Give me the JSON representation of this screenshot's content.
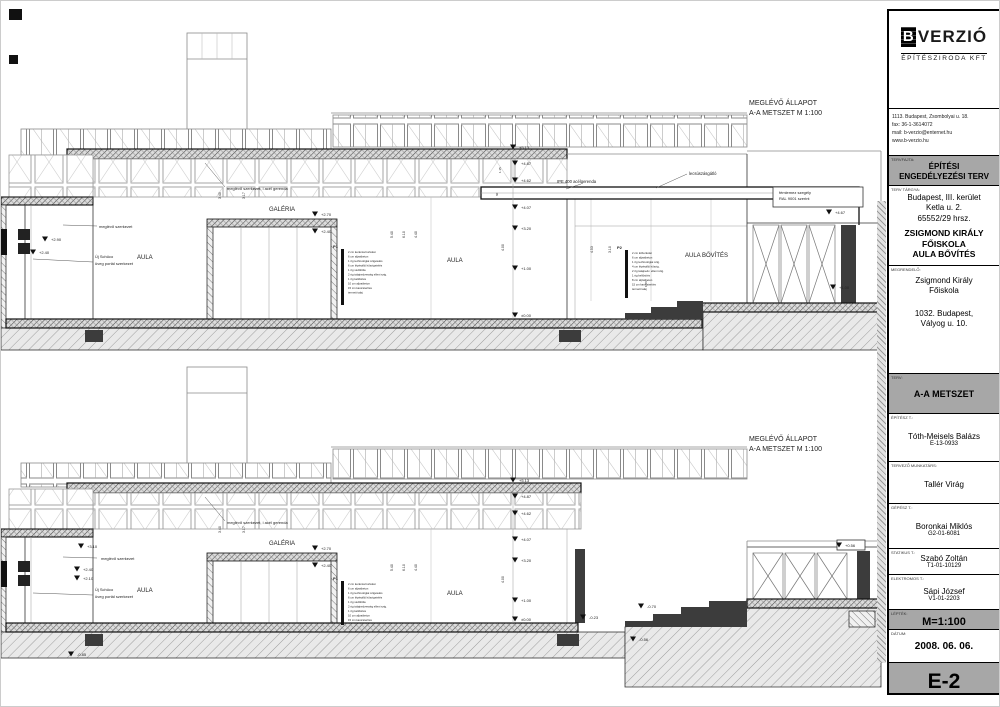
{
  "title_block": {
    "logo": {
      "b": "B",
      "name": "VERZIÓ",
      "sub": "ÉPÍTÉSZIRODA KFT"
    },
    "address_lines": [
      "1113. Budapest, Zsombolyai u. 18.",
      "fax: 36-1-3614072",
      "mail: b-verzio@enternet.hu",
      "www.b-verzio.hu"
    ],
    "tervfajta_label": "TERVFAJTA:",
    "tervfajta_line1": "ÉPÍTÉSI",
    "tervfajta_line2": "ENGEDÉLYEZÉSI TERV",
    "targy_label": "TERV TÁRGYA:",
    "targy_lines": [
      "Budapest, III. kerület",
      "Ketla u. 2.",
      "65552/29 hrsz."
    ],
    "targy_bold": [
      "ZSIGMOND KIRÁLY",
      "FŐISKOLA",
      "AULA BŐVÍTÉS"
    ],
    "megrendelo_label": "MEGRENDELŐ:",
    "megrendelo_lines": [
      "Zsigmond Király",
      "Főiskola"
    ],
    "megrendelo_addr": [
      "1032.  Budapest,",
      "Vályog u. 10."
    ],
    "terv_label": "TERV:",
    "terv": "A-A METSZET",
    "people": [
      {
        "role": "ÉPÍTÉSZ T.:",
        "name": "Tóth-Meisels Balázs",
        "id": "E-13-0933"
      },
      {
        "role": "TERVEZŐ MUNKATÁRS:",
        "name": "Tallér Virág",
        "id": ""
      },
      {
        "role": "GÉPÉSZ T.:",
        "name": "Boronkai Miklós",
        "id": "G2-01-6081"
      },
      {
        "role": "STATIKUS T.:",
        "name": "Szabó Zoltán",
        "id": "T1-01-10129"
      },
      {
        "role": "ELEKTROMOS T.:",
        "name": "Sápi József",
        "id": "V1-01-2203"
      }
    ],
    "leptek_label": "LÉPTÉK:",
    "leptek": "M=1:100",
    "datum_label": "DÁTUM:",
    "datum": "2008. 06. 06.",
    "sheet_no": "E-2"
  },
  "colors": {
    "gray_box": "#a7a7a7",
    "dark_fill": "#3c3c3c",
    "line": "#333333"
  },
  "drawings": {
    "top": {
      "annotations": [
        {
          "t": "MEGLÉVŐ ÁLLAPOT",
          "x": 748,
          "y": 104,
          "s": 7
        },
        {
          "t": "A-A METSZET M 1:100",
          "x": 748,
          "y": 114,
          "s": 7
        },
        {
          "t": "meglévő szerkezet, i acél gerenda",
          "x": 226,
          "y": 189,
          "s": 4
        },
        {
          "t": "GALÉRIA",
          "x": 268,
          "y": 210,
          "s": 6
        },
        {
          "t": "AULA",
          "x": 136,
          "y": 258,
          "s": 6
        },
        {
          "t": "AULA",
          "x": 446,
          "y": 261,
          "s": 6
        },
        {
          "t": "AULA BŐVÍTÉS",
          "x": 684,
          "y": 256,
          "s": 6
        },
        {
          "t": "meglévő szerkezet",
          "x": 98,
          "y": 227,
          "s": 4
        },
        {
          "t": "Új Schüco",
          "x": 94,
          "y": 257,
          "s": 4
        },
        {
          "t": "üveg portál szerkezet",
          "x": 94,
          "y": 264,
          "s": 4
        },
        {
          "t": "IPE 400 acélgerenda",
          "x": 556,
          "y": 182,
          "s": 4.2
        },
        {
          "t": "lecsúszásgátló",
          "x": 688,
          "y": 174,
          "s": 4.2
        },
        {
          "t": "fémlemez szegély",
          "x": 778,
          "y": 193,
          "s": 4
        },
        {
          "t": "RAL 9001 szerint",
          "x": 778,
          "y": 199,
          "s": 4
        },
        {
          "k": "elev",
          "t": "+5.13",
          "x": 518,
          "y": 148,
          "s": 4
        },
        {
          "k": "elev",
          "t": "+4.87",
          "x": 520,
          "y": 164,
          "s": 4
        },
        {
          "k": "elev",
          "t": "+4.62",
          "x": 520,
          "y": 181,
          "s": 4
        },
        {
          "k": "elev",
          "t": "+4.07",
          "x": 520,
          "y": 208,
          "s": 4
        },
        {
          "k": "elev",
          "t": "+3.20",
          "x": 520,
          "y": 229,
          "s": 4
        },
        {
          "k": "elev",
          "t": "+1.00",
          "x": 520,
          "y": 269,
          "s": 4
        },
        {
          "k": "elev",
          "t": "±0.00",
          "x": 520,
          "y": 316,
          "s": 4
        },
        {
          "k": "elev",
          "t": "+2.90",
          "x": 50,
          "y": 240,
          "s": 4
        },
        {
          "k": "elev",
          "t": "+2.40",
          "x": 38,
          "y": 253,
          "s": 4
        },
        {
          "k": "elev",
          "t": "+2.70",
          "x": 320,
          "y": 215,
          "s": 4
        },
        {
          "k": "elev",
          "t": "+2.40",
          "x": 320,
          "y": 232,
          "s": 4
        },
        {
          "k": "elev",
          "t": "+4.67",
          "x": 834,
          "y": 213,
          "s": 4
        },
        {
          "k": "elev",
          "t": "+1.00",
          "x": 838,
          "y": 288,
          "s": 4
        },
        {
          "t": "3.40",
          "x": 220,
          "y": 198,
          "r": -90,
          "s": 3.5
        },
        {
          "t": "3.17",
          "x": 244,
          "y": 198,
          "r": -90,
          "s": 3.5
        },
        {
          "t": "5.40",
          "x": 392,
          "y": 237,
          "r": -90,
          "s": 3.5
        },
        {
          "t": "6.10",
          "x": 404,
          "y": 237,
          "r": -90,
          "s": 3.5
        },
        {
          "t": "4.40",
          "x": 416,
          "y": 237,
          "r": -90,
          "s": 3.5
        },
        {
          "t": "4.00",
          "x": 503,
          "y": 250,
          "r": -90,
          "s": 3.5
        },
        {
          "t": "1.15",
          "x": 500,
          "y": 172,
          "r": -90,
          "s": 3
        },
        {
          "t": "60",
          "x": 497,
          "y": 195,
          "r": -90,
          "s": 3
        },
        {
          "t": "4.53",
          "x": 592,
          "y": 252,
          "r": -90,
          "s": 3.5
        },
        {
          "t": "3.10",
          "x": 610,
          "y": 252,
          "r": -90,
          "s": 3.5
        },
        {
          "t": "1.06",
          "x": 646,
          "y": 286,
          "r": -90,
          "s": 3
        },
        {
          "t": "P1",
          "x": 332,
          "y": 247,
          "s": 4,
          "b": 1
        },
        {
          "t": "2 cm kerámia burkolat",
          "x": 347,
          "y": 252,
          "s": 2.8
        },
        {
          "t": "6 cm aljzatbeton",
          "x": 347,
          "y": 256.5,
          "s": 2.8
        },
        {
          "t": "1 rtg technológiai szigetelés",
          "x": 347,
          "y": 261,
          "s": 2.8
        },
        {
          "t": "6 cm lépésálló hőszigetelés",
          "x": 347,
          "y": 265.5,
          "s": 2.8
        },
        {
          "t": "1 rtg védőfólia",
          "x": 347,
          "y": 270,
          "s": 2.8
        },
        {
          "t": "2 rtg talajnedvesség elleni szig.",
          "x": 347,
          "y": 274.5,
          "s": 2.8
        },
        {
          "t": "1 rtg kellősítés",
          "x": 347,
          "y": 279,
          "s": 2.8
        },
        {
          "t": "10 cm aljzatbeton",
          "x": 347,
          "y": 283.5,
          "s": 2.8
        },
        {
          "t": "15 cm kavicsterítés",
          "x": 347,
          "y": 288,
          "s": 2.8
        },
        {
          "t": "termett talaj",
          "x": 347,
          "y": 292.5,
          "s": 2.8
        },
        {
          "t": "P2",
          "x": 616,
          "y": 248,
          "s": 4,
          "b": 1
        },
        {
          "t": "2 cm kőburkolat",
          "x": 631,
          "y": 253,
          "s": 2.8
        },
        {
          "t": "6 cm aljzatbeton",
          "x": 631,
          "y": 257.5,
          "s": 2.8
        },
        {
          "t": "1 rtg technológiai szig.",
          "x": 631,
          "y": 262,
          "s": 2.8
        },
        {
          "t": "4 cm lépésálló hőszig.",
          "x": 631,
          "y": 266.5,
          "s": 2.8
        },
        {
          "t": "2 rtg talajnedv. elleni szig.",
          "x": 631,
          "y": 271,
          "s": 2.8
        },
        {
          "t": "1 rtg kellősítés",
          "x": 631,
          "y": 275.5,
          "s": 2.8
        },
        {
          "t": "8 cm aljzatbeton",
          "x": 631,
          "y": 280,
          "s": 2.8
        },
        {
          "t": "15 cm kavicsterítés",
          "x": 631,
          "y": 284.5,
          "s": 2.8
        },
        {
          "t": "termett talaj",
          "x": 631,
          "y": 289,
          "s": 2.8
        }
      ]
    },
    "bottom": {
      "annotations": [
        {
          "t": "MEGLÉVŐ ÁLLAPOT",
          "x": 748,
          "y": 440,
          "s": 7
        },
        {
          "t": "A-A METSZET M 1:100",
          "x": 748,
          "y": 450,
          "s": 7
        },
        {
          "t": "meglévő szerkezet, i acél gerenda",
          "x": 226,
          "y": 523,
          "s": 4
        },
        {
          "t": "GALÉRIA",
          "x": 268,
          "y": 544,
          "s": 6
        },
        {
          "t": "AULA",
          "x": 136,
          "y": 591,
          "s": 6
        },
        {
          "t": "AULA",
          "x": 446,
          "y": 594,
          "s": 6
        },
        {
          "t": "meglévő szerkezet",
          "x": 100,
          "y": 559,
          "s": 4
        },
        {
          "t": "Új Schüco",
          "x": 94,
          "y": 590,
          "s": 4
        },
        {
          "t": "üveg portál szerkezet",
          "x": 94,
          "y": 597,
          "s": 4
        },
        {
          "k": "elev",
          "t": "+5.13",
          "x": 518,
          "y": 481,
          "s": 4
        },
        {
          "k": "elev",
          "t": "+4.87",
          "x": 520,
          "y": 497,
          "s": 4
        },
        {
          "k": "elev",
          "t": "+4.62",
          "x": 520,
          "y": 514,
          "s": 4
        },
        {
          "k": "elev",
          "t": "+4.07",
          "x": 520,
          "y": 540,
          "s": 4
        },
        {
          "k": "elev",
          "t": "+3.20",
          "x": 520,
          "y": 561,
          "s": 4
        },
        {
          "k": "elev",
          "t": "+1.00",
          "x": 520,
          "y": 601,
          "s": 4
        },
        {
          "k": "elev",
          "t": "±0.00",
          "x": 520,
          "y": 620,
          "s": 4
        },
        {
          "k": "elev",
          "t": "+3.10",
          "x": 86,
          "y": 547,
          "s": 4
        },
        {
          "k": "elev",
          "t": "+2.40",
          "x": 82,
          "y": 570,
          "s": 4
        },
        {
          "k": "elev",
          "t": "+2.10",
          "x": 82,
          "y": 579,
          "s": 4
        },
        {
          "k": "elev",
          "t": "+2.70",
          "x": 320,
          "y": 549,
          "s": 4
        },
        {
          "k": "elev",
          "t": "+2.40",
          "x": 320,
          "y": 566,
          "s": 4
        },
        {
          "k": "elev",
          "t": "-0.23",
          "x": 588,
          "y": 618,
          "s": 4
        },
        {
          "k": "elev",
          "t": "-0.70",
          "x": 646,
          "y": 607,
          "s": 4
        },
        {
          "k": "elev",
          "t": "-0.56",
          "x": 638,
          "y": 640,
          "s": 4
        },
        {
          "k": "elev",
          "t": "-0.85",
          "x": 76,
          "y": 655,
          "s": 4
        },
        {
          "k": "elev",
          "t": "+0.56",
          "x": 844,
          "y": 546,
          "s": 4
        },
        {
          "t": "3.40",
          "x": 220,
          "y": 532,
          "r": -90,
          "s": 3.5
        },
        {
          "t": "3.17",
          "x": 244,
          "y": 532,
          "r": -90,
          "s": 3.5
        },
        {
          "t": "5.40",
          "x": 392,
          "y": 570,
          "r": -90,
          "s": 3.5
        },
        {
          "t": "6.10",
          "x": 404,
          "y": 570,
          "r": -90,
          "s": 3.5
        },
        {
          "t": "4.40",
          "x": 416,
          "y": 570,
          "r": -90,
          "s": 3.5
        },
        {
          "t": "4.00",
          "x": 503,
          "y": 582,
          "r": -90,
          "s": 3.5
        },
        {
          "t": "P1",
          "x": 332,
          "y": 579,
          "s": 4,
          "b": 1
        },
        {
          "t": "2 cm kerámia burkolat",
          "x": 347,
          "y": 584,
          "s": 2.8
        },
        {
          "t": "6 cm aljzatbeton",
          "x": 347,
          "y": 588.5,
          "s": 2.8
        },
        {
          "t": "1 rtg technológiai szigetelés",
          "x": 347,
          "y": 593,
          "s": 2.8
        },
        {
          "t": "6 cm lépésálló hőszigetelés",
          "x": 347,
          "y": 597.5,
          "s": 2.8
        },
        {
          "t": "1 rtg védőfólia",
          "x": 347,
          "y": 602,
          "s": 2.8
        },
        {
          "t": "2 rtg talajnedvesség elleni szig.",
          "x": 347,
          "y": 606.5,
          "s": 2.8
        },
        {
          "t": "1 rtg kellősítés",
          "x": 347,
          "y": 611,
          "s": 2.8
        },
        {
          "t": "10 cm aljzatbeton",
          "x": 347,
          "y": 615.5,
          "s": 2.8
        },
        {
          "t": "15 cm kavicsterítés",
          "x": 347,
          "y": 620,
          "s": 2.8
        }
      ]
    }
  }
}
